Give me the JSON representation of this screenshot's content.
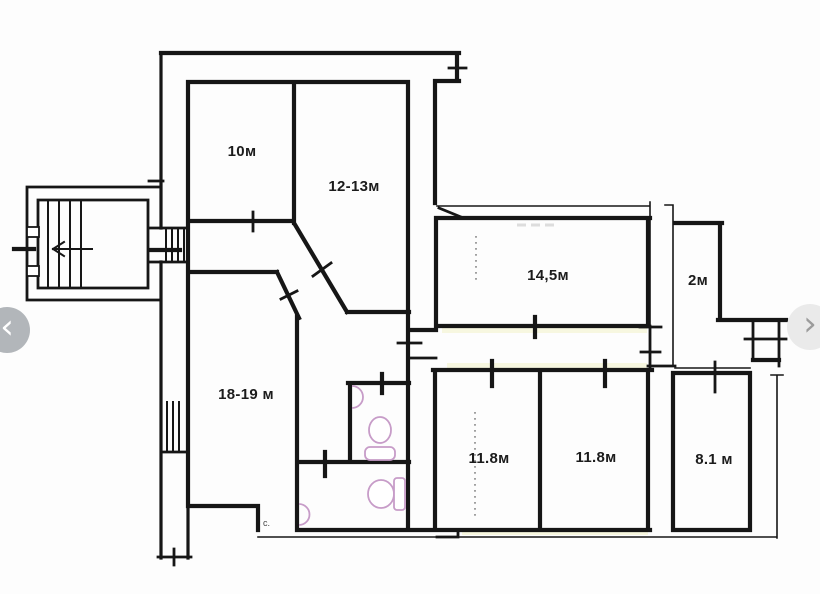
{
  "viewer": {
    "prev_glyph": "‹",
    "next_glyph": "›"
  },
  "floorplan": {
    "rooms": [
      "10м",
      "12-13м",
      "14,5м",
      "2м",
      "18-19 м",
      "11.8м",
      "11.8м",
      "8.1 м"
    ],
    "entry_mark": "c.",
    "colors": {
      "wall": "#161616",
      "fixture_pink": "#c79cc8",
      "corridor_tint": "#f7f7dd",
      "nav_left_bg": "#b2b6ba",
      "nav_left_glyph": "#ffffff",
      "nav_right_bg": "#eaeaea",
      "nav_right_glyph": "#9b9b9b"
    }
  }
}
